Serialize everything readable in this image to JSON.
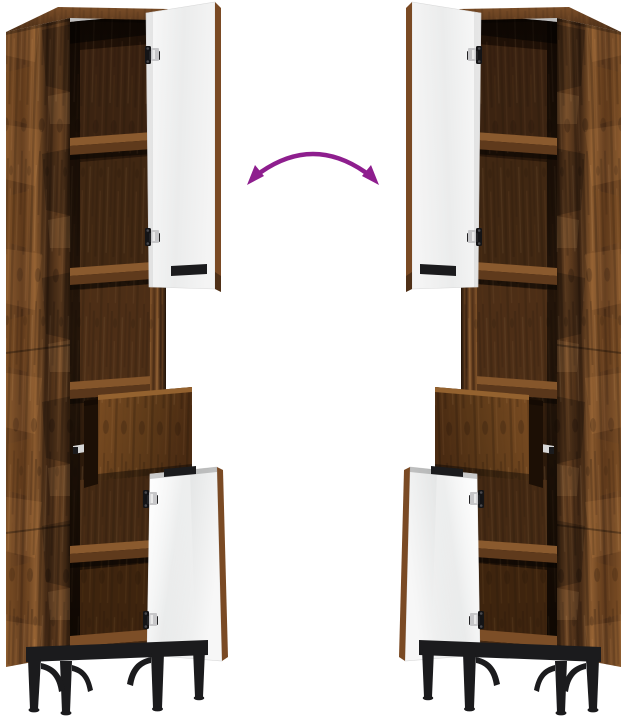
{
  "scene": {
    "background": "#ffffff",
    "alt": "Tall narrow rustic smoked-oak storage cabinet shown twice in mirrored configurations: open shelf compartments, a tall white upper door standing open, a pulled-out drawer and an open white lower door, on black metal legs; a purple curved double-headed arrow between the two cabinets indicates the reversible door direction"
  },
  "colors": {
    "background": "#ffffff",
    "wood_light": "#8a5a2e",
    "wood_mid": "#6b4423",
    "wood_dark": "#3c2412",
    "wood_deep": "#1c0e05",
    "door_white": "#f2f3f3",
    "door_edge_wood": "#7a4a24",
    "hardware_black": "#1b1b1d",
    "hinge_metal": "#c7c7c9",
    "drawer_slide_metal": "#d6d6d6",
    "arrow_purple": "#8e1e8e"
  },
  "icons": {
    "arrow": "reversible-direction-arrow"
  }
}
